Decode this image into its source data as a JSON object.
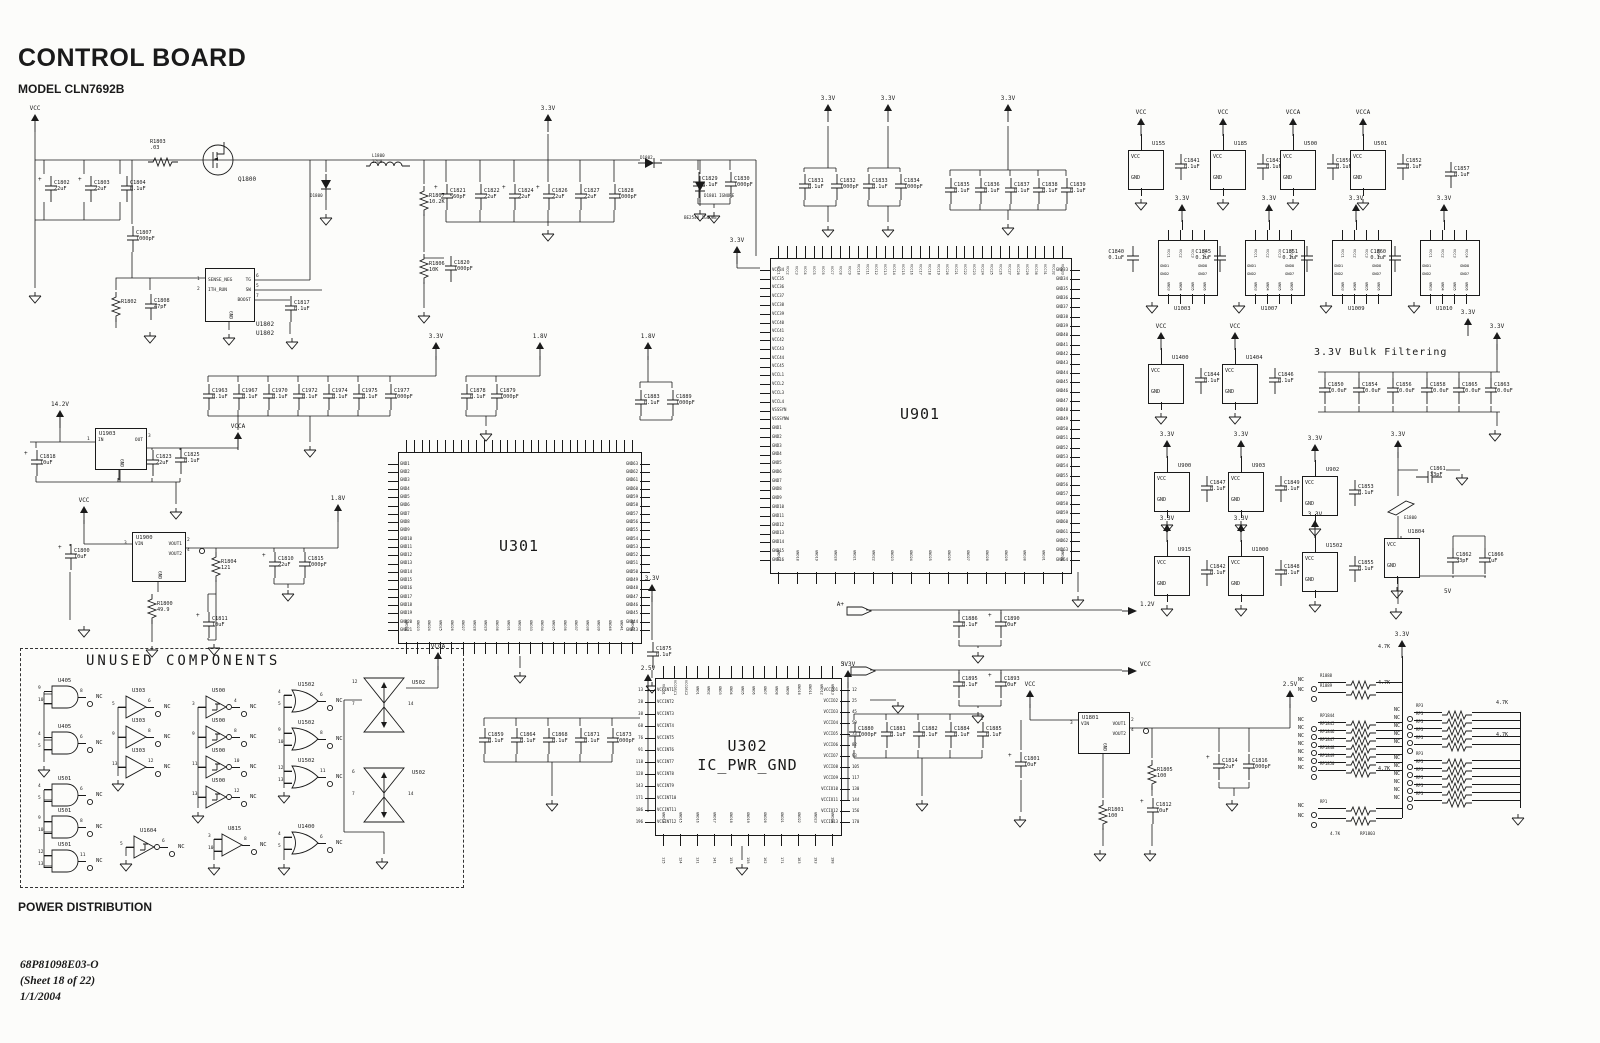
{
  "meta": {
    "title": "CONTROL BOARD",
    "model": "MODEL CLN7692B",
    "section": "POWER DISTRIBUTION",
    "doc": "68P81098E03-O",
    "sheet": "(Sheet 18 of 22)",
    "date": "1/1/2004"
  },
  "labels": [
    [
      "UNUSED COMPONENTS",
      86,
      650,
      "sec"
    ],
    [
      "3.3V Bulk Filtering",
      1314,
      340,
      "bulk"
    ],
    [
      "5V",
      1444,
      578,
      "sm"
    ],
    [
      "BE2540 IGNORE",
      684,
      204,
      "xs"
    ],
    [
      "U1802",
      256,
      320,
      "sm"
    ],
    [
      "Q1800",
      238,
      166,
      "sm"
    ],
    [
      "D1800",
      310,
      182,
      "xs"
    ],
    [
      "D1802",
      640,
      144,
      "xs"
    ],
    [
      "D1801 IGNORE",
      704,
      182,
      "xs"
    ],
    [
      "E1800",
      1404,
      504,
      "xs"
    ],
    [
      "L1800",
      372,
      142,
      "xs"
    ],
    [
      "22uH",
      372,
      148,
      "xs"
    ],
    [
      "RP1803",
      1360,
      820,
      "xs"
    ],
    [
      "4.7K",
      1330,
      820,
      "xs"
    ]
  ],
  "flags": [
    [
      "VCC",
      35,
      114
    ],
    [
      "3.3V",
      548,
      114
    ],
    [
      "3.3V",
      828,
      104
    ],
    [
      "3.3V",
      888,
      104
    ],
    [
      "3.3V",
      1008,
      104
    ],
    [
      "3.3V",
      737,
      246
    ],
    [
      "14.2V",
      60,
      410
    ],
    [
      "3.3V",
      436,
      342
    ],
    [
      "VCCA",
      238,
      432
    ],
    [
      "1.8V",
      540,
      342
    ],
    [
      "1.8V",
      648,
      342
    ],
    [
      "VCC",
      84,
      506
    ],
    [
      "1.8V",
      338,
      504
    ],
    [
      "3.3V",
      652,
      584
    ],
    [
      "2.5V",
      648,
      674
    ],
    [
      "3.3V",
      848,
      670
    ],
    [
      "VCC",
      1030,
      690
    ],
    [
      "2.5V",
      1290,
      690
    ],
    [
      "3.3V",
      1468,
      318
    ],
    [
      "3.3V",
      1497,
      332
    ],
    [
      "3.3V",
      1398,
      440
    ],
    [
      "3.3V",
      1402,
      640
    ],
    [
      "VCCA",
      438,
      652
    ]
  ],
  "tags": [
    [
      "A+",
      846,
      606
    ],
    [
      "5V",
      850,
      666
    ],
    [
      "LOGIC_GND",
      806,
      696
    ]
  ],
  "out_arrows": [
    [
      "1.2V",
      1122,
      606
    ],
    [
      "VCC",
      1122,
      666
    ]
  ],
  "gnds": [
    [
      35,
      290
    ],
    [
      326,
      212
    ],
    [
      229,
      332
    ],
    [
      150,
      330
    ],
    [
      292,
      336
    ],
    [
      424,
      310
    ],
    [
      548,
      228
    ],
    [
      700,
      208
    ],
    [
      714,
      210
    ],
    [
      828,
      224
    ],
    [
      888,
      224
    ],
    [
      1008,
      222
    ],
    [
      310,
      444
    ],
    [
      176,
      506
    ],
    [
      84,
      624
    ],
    [
      152,
      644
    ],
    [
      214,
      642
    ],
    [
      288,
      588
    ],
    [
      486,
      428
    ],
    [
      520,
      670
    ],
    [
      652,
      680
    ],
    [
      742,
      862
    ],
    [
      552,
      798
    ],
    [
      922,
      798
    ],
    [
      978,
      650
    ],
    [
      978,
      710
    ],
    [
      898,
      700
    ],
    [
      1078,
      594
    ],
    [
      1020,
      814
    ],
    [
      1100,
      848
    ],
    [
      1150,
      848
    ],
    [
      1232,
      798
    ],
    [
      1495,
      428
    ],
    [
      1462,
      472
    ],
    [
      1396,
      606
    ],
    [
      1518,
      812
    ],
    [
      44,
      764
    ],
    [
      118,
      778
    ],
    [
      198,
      810
    ],
    [
      284,
      790
    ],
    [
      126,
      858
    ],
    [
      214,
      862
    ],
    [
      284,
      862
    ],
    [
      382,
      856
    ]
  ],
  "caps": [
    [
      "C1802",
      "22uF",
      44,
      176,
      "p"
    ],
    [
      "C1803",
      "22uF",
      84,
      176,
      "p"
    ],
    [
      "C1804",
      "0.1uF",
      120,
      176,
      ""
    ],
    [
      "C1807",
      "1000pF",
      126,
      226,
      ""
    ],
    [
      "C1808",
      "47pF",
      144,
      294,
      ""
    ],
    [
      "C1817",
      "0.1uF",
      284,
      296,
      ""
    ],
    [
      "C1821",
      "560pF",
      440,
      184,
      "p"
    ],
    [
      "C1822",
      "22uF",
      474,
      184,
      ""
    ],
    [
      "C1824",
      "22uF",
      508,
      184,
      "p"
    ],
    [
      "C1826",
      "22uF",
      542,
      184,
      "p"
    ],
    [
      "C1827",
      "22uF",
      574,
      184,
      ""
    ],
    [
      "C1828",
      "1000pF",
      608,
      184,
      ""
    ],
    [
      "C1829",
      "0.1uF",
      692,
      172,
      ""
    ],
    [
      "C1830",
      "1000pF",
      724,
      172,
      ""
    ],
    [
      "C1820",
      "1000pF",
      444,
      256,
      ""
    ],
    [
      "C1818",
      "10uF",
      30,
      450,
      "p"
    ],
    [
      "C1813",
      "0.1uF",
      112,
      454,
      ""
    ],
    [
      "C1823",
      "22uF",
      146,
      450,
      "p"
    ],
    [
      "C1825",
      "0.1uF",
      174,
      448,
      ""
    ],
    [
      "C1800",
      "10uF",
      64,
      544,
      "p"
    ],
    [
      "C1810",
      "22uF",
      268,
      552,
      "p"
    ],
    [
      "C1815",
      "1000pF",
      298,
      552,
      ""
    ],
    [
      "C1811",
      "10uF",
      202,
      612,
      "p"
    ],
    [
      "C1963",
      "0.1uF",
      202,
      384,
      ""
    ],
    [
      "C1967",
      "0.1uF",
      232,
      384,
      ""
    ],
    [
      "C1970",
      "0.1uF",
      262,
      384,
      ""
    ],
    [
      "C1972",
      "0.1uF",
      292,
      384,
      ""
    ],
    [
      "C1974",
      "0.1uF",
      322,
      384,
      ""
    ],
    [
      "C1975",
      "0.1uF",
      352,
      384,
      ""
    ],
    [
      "C1977",
      "1000pF",
      384,
      384,
      ""
    ],
    [
      "C1878",
      "0.1uF",
      460,
      384,
      ""
    ],
    [
      "C1879",
      "1000pF",
      490,
      384,
      ""
    ],
    [
      "C1883",
      "0.1uF",
      634,
      390,
      ""
    ],
    [
      "C1889",
      "1000pF",
      666,
      390,
      ""
    ],
    [
      "C1831",
      "0.1uF",
      798,
      174,
      ""
    ],
    [
      "C1832",
      "1000pF",
      830,
      174,
      ""
    ],
    [
      "C1833",
      "0.1uF",
      862,
      174,
      ""
    ],
    [
      "C1834",
      "1000pF",
      894,
      174,
      ""
    ],
    [
      "C1835",
      "0.1uF",
      944,
      178,
      ""
    ],
    [
      "C1836",
      "0.1uF",
      974,
      178,
      ""
    ],
    [
      "C1837",
      "0.1uF",
      1004,
      178,
      ""
    ],
    [
      "C1838",
      "0.1uF",
      1032,
      178,
      ""
    ],
    [
      "C1839",
      "0.1uF",
      1060,
      178,
      ""
    ],
    [
      "C1875",
      "0.1uF",
      646,
      642,
      ""
    ],
    [
      "C1859",
      "0.1uF",
      478,
      728,
      ""
    ],
    [
      "C1864",
      "0.1uF",
      510,
      728,
      ""
    ],
    [
      "C1868",
      "0.1uF",
      542,
      728,
      ""
    ],
    [
      "C1871",
      "0.1uF",
      574,
      728,
      ""
    ],
    [
      "C1873",
      "1000pF",
      606,
      728,
      ""
    ],
    [
      "C1880",
      "1000pF",
      848,
      722,
      ""
    ],
    [
      "C1881",
      "0.1uF",
      880,
      722,
      ""
    ],
    [
      "C1882",
      "0.1uF",
      912,
      722,
      ""
    ],
    [
      "C1884",
      "0.1uF",
      944,
      722,
      ""
    ],
    [
      "C1885",
      "0.1uF",
      976,
      722,
      ""
    ],
    [
      "C1886",
      "0.1uF",
      952,
      612,
      ""
    ],
    [
      "C1890",
      "10uF",
      994,
      612,
      "p"
    ],
    [
      "C1895",
      "0.1uF",
      952,
      672,
      ""
    ],
    [
      "C1893",
      "10uF",
      994,
      672,
      "p"
    ],
    [
      "C1801",
      "10uF",
      1014,
      752,
      "p"
    ],
    [
      "C1812",
      "10uF",
      1146,
      798,
      "p"
    ],
    [
      "C1814",
      "22uF",
      1212,
      754,
      "p"
    ],
    [
      "C1816",
      "1000pF",
      1242,
      754,
      ""
    ],
    [
      "C1857",
      "0.1uF",
      1444,
      162,
      ""
    ],
    [
      "C1861",
      "33pF",
      1420,
      462,
      "h"
    ],
    [
      "C1862",
      "33pF",
      1446,
      548,
      ""
    ],
    [
      "C1866",
      "1uF",
      1478,
      548,
      ""
    ],
    [
      "C1850",
      "10.0uF",
      1318,
      378,
      ""
    ],
    [
      "C1854",
      "10.0uF",
      1352,
      378,
      ""
    ],
    [
      "C1856",
      "10.0uF",
      1386,
      378,
      ""
    ],
    [
      "C1858",
      "10.0uF",
      1420,
      378,
      ""
    ],
    [
      "C1865",
      "10.0uF",
      1452,
      378,
      ""
    ],
    [
      "C1863",
      "10.0uF",
      1484,
      378,
      ""
    ]
  ],
  "resistors": [
    [
      "R1803",
      ".03",
      148,
      153,
      "h"
    ],
    [
      "R1807",
      "10.2K",
      418,
      186,
      "v"
    ],
    [
      "R1806",
      "10K",
      418,
      254,
      "v"
    ],
    [
      "R1802",
      "",
      110,
      292,
      "v"
    ],
    [
      "R1804",
      "121",
      210,
      552,
      "v"
    ],
    [
      "R1800",
      "49.9",
      146,
      594,
      "v"
    ],
    [
      "R1805",
      "100",
      1146,
      760,
      "v"
    ],
    [
      "R1801",
      "100",
      1097,
      800,
      "v"
    ]
  ],
  "diodes": [
    [
      "D1800",
      320,
      174,
      "v"
    ],
    [
      "D1801",
      694,
      176,
      "v"
    ],
    [
      "D1802",
      638,
      154,
      "h"
    ]
  ],
  "inductor": {
    "ref": "L1800",
    "x": 366,
    "y": 154
  },
  "mosfet": {
    "ref": "Q1800",
    "x": 200,
    "y": 142
  },
  "ferrite": {
    "ref": "E1800",
    "x": 1386,
    "y": 498
  },
  "big_ics": {
    "u901": {
      "ref": "U901",
      "x": 770,
      "y": 258,
      "w": 300,
      "h": 314,
      "left": [
        {
          "p": "VCC",
          "f": 34,
          "t": 45
        },
        {
          "p": "VCCL",
          "f": 1,
          "t": 4
        },
        "VSSSYN",
        "VSSSYNW",
        {
          "p": "GND",
          "f": 1,
          "t": 16
        }
      ],
      "right": [
        {
          "p": "GND",
          "f": 33,
          "t": 64
        }
      ],
      "top": [
        {
          "p": "VCC",
          "f": 1,
          "t": 33
        }
      ],
      "bottom": [
        {
          "p": "GND",
          "f": 17,
          "t": 32
        }
      ]
    },
    "u301": {
      "ref": "U301",
      "x": 398,
      "y": 452,
      "w": 242,
      "h": 190,
      "left": [
        {
          "p": "GND",
          "f": 1,
          "t": 21
        }
      ],
      "right": [
        {
          "p": "GND",
          "f": 63,
          "t": 43
        }
      ],
      "top": {
        "n": 30
      },
      "bottom": [
        {
          "p": "GND",
          "f": 22,
          "t": 42
        }
      ]
    },
    "u302": {
      "ref": "U302",
      "sub": "IC_PWR_GND",
      "x": 655,
      "y": 678,
      "w": 185,
      "h": 156,
      "left": [
        {
          "p": "VCCINT",
          "f": 1,
          "t": 12
        }
      ],
      "leftNums": [
        13,
        28,
        38,
        68,
        76,
        91,
        118,
        128,
        143,
        171,
        186,
        196
      ],
      "right": [
        {
          "p": "VCCIO",
          "f": 1,
          "t": 13
        }
      ],
      "rightNums": [
        12,
        25,
        45,
        59,
        73,
        82,
        93,
        105,
        117,
        130,
        144,
        156,
        170
      ],
      "top": [
        "VCCQ1",
        "VCCOSC1",
        "VCCOSC2",
        {
          "p": "GND",
          "f": 1,
          "t": 13
        }
      ],
      "bottom": [
        {
          "p": "GND",
          "f": 14,
          "t": 24
        }
      ],
      "botNums": [
        115,
        124,
        131,
        141,
        153,
        158,
        162,
        171,
        183,
        193,
        198
      ]
    }
  },
  "small_ics": [
    {
      "ref": "U1802",
      "x": 205,
      "y": 268,
      "w": 48,
      "h": 52,
      "L": [
        [
          "1",
          "SENSE_NEG"
        ],
        [
          "2",
          "ITH_RUN"
        ]
      ],
      "R": [
        [
          "6",
          "TG"
        ],
        [
          "5",
          "SW"
        ],
        [
          "7",
          "BOOST"
        ]
      ],
      "B": [
        "GND"
      ],
      "noref": true
    },
    {
      "ref": "U1903",
      "x": 95,
      "y": 428,
      "w": 50,
      "h": 40,
      "L": [
        [
          "1",
          "IN"
        ]
      ],
      "R": [
        [
          "3",
          "OUT"
        ]
      ],
      "B": [
        "GND"
      ]
    },
    {
      "ref": "U1900",
      "x": 132,
      "y": 532,
      "w": 52,
      "h": 48,
      "L": [
        [
          "3",
          "VIN"
        ]
      ],
      "R": [
        [
          "2",
          "VOUT1"
        ],
        [
          "4",
          "VOUT2"
        ]
      ],
      "B": [
        "GND"
      ],
      "nc": 0
    },
    {
      "ref": "U1801",
      "x": 1078,
      "y": 712,
      "w": 50,
      "h": 40,
      "L": [
        [
          "3",
          "VIN"
        ]
      ],
      "R": [
        [
          "2",
          "VOUT1"
        ],
        [
          "4",
          "VOUT2"
        ]
      ],
      "B": [
        "GND"
      ],
      "nc": 0
    }
  ],
  "pwrblocks": [
    [
      "U155",
      1128,
      150,
      "VCC",
      "C1841",
      "0.1uF"
    ],
    [
      "U185",
      1210,
      150,
      "VCC",
      "C1843",
      "0.1uF"
    ],
    [
      "U500",
      1280,
      150,
      "VCCA",
      "C1850",
      "0.1uF"
    ],
    [
      "U501",
      1350,
      150,
      "VCCA",
      "C1852",
      "0.1uF"
    ],
    [
      "U1400",
      1148,
      364,
      "VCC",
      "C1844",
      "0.1uF"
    ],
    [
      "U1404",
      1222,
      364,
      "VCC",
      "C1846",
      "0.1uF"
    ],
    [
      "U900",
      1154,
      472,
      "3.3V",
      "C1847",
      "0.1uF"
    ],
    [
      "U903",
      1228,
      472,
      "3.3V",
      "C1849",
      "0.1uF"
    ],
    [
      "U902",
      1302,
      476,
      "3.3V",
      "C1853",
      "0.1uF"
    ],
    [
      "U915",
      1154,
      556,
      "3.3V",
      "C1842",
      "0.1uF"
    ],
    [
      "U1000",
      1228,
      556,
      "3.3V",
      "C1848",
      "0.1uF"
    ],
    [
      "U1502",
      1302,
      552,
      "3.3V",
      "C1855",
      "0.1uF"
    ],
    [
      "U1804",
      1384,
      538,
      "",
      "",
      ""
    ]
  ],
  "quads": [
    [
      "U1003",
      1158,
      240,
      "C1840",
      "0.1uF"
    ],
    [
      "U1007",
      1245,
      240,
      "C1845",
      "0.1uF"
    ],
    [
      "U1009",
      1332,
      240,
      "C1851",
      "0.1uF"
    ],
    [
      "U1010",
      1420,
      240,
      "C1860",
      "0.1uF"
    ]
  ],
  "quad_pins": {
    "top": [
      "VCC1",
      "VCC2",
      "VCC3",
      "VCC4"
    ],
    "left": [
      "GND1",
      "GND2"
    ],
    "right": [
      "GND8",
      "GND7"
    ],
    "bottom": [
      "GND3",
      "GND4",
      "GND5",
      "GND6"
    ]
  },
  "unused": {
    "gates": [
      [
        "and",
        "U405",
        52,
        686,
        [
          "9",
          "10"
        ],
        "8"
      ],
      [
        "and",
        "U405",
        52,
        732,
        [
          "4",
          "5"
        ],
        "6"
      ],
      [
        "and",
        "U501",
        52,
        784,
        [
          "4",
          "5"
        ],
        "6"
      ],
      [
        "and",
        "U501",
        52,
        816,
        [
          "9",
          "10"
        ],
        "8"
      ],
      [
        "and",
        "U501",
        52,
        850,
        [
          "12",
          "13"
        ],
        "11"
      ],
      [
        "buf",
        "U303",
        126,
        696,
        [
          "5"
        ],
        "6"
      ],
      [
        "buf",
        "U303",
        126,
        726,
        [
          "9"
        ],
        "8"
      ],
      [
        "buf",
        "U303",
        126,
        756,
        [
          "13"
        ],
        "12"
      ],
      [
        "sinv",
        "U500",
        206,
        696,
        [
          "3"
        ],
        "4"
      ],
      [
        "sinv",
        "U500",
        206,
        726,
        [
          "9"
        ],
        "8"
      ],
      [
        "sinv",
        "U500",
        206,
        756,
        [
          "11"
        ],
        "10"
      ],
      [
        "sinv",
        "U500",
        206,
        786,
        [
          "13"
        ],
        "12"
      ],
      [
        "or",
        "U1502",
        292,
        690,
        [
          "4",
          "5"
        ],
        "6"
      ],
      [
        "or",
        "U1502",
        292,
        728,
        [
          "9",
          "10"
        ],
        "8"
      ],
      [
        "or",
        "U1502",
        292,
        766,
        [
          "12",
          "13"
        ],
        "11"
      ],
      [
        "sinv",
        "U1604",
        134,
        836,
        [
          "5"
        ],
        "6"
      ],
      [
        "buf2",
        "U815",
        222,
        834,
        [
          "3",
          "10"
        ],
        "8"
      ],
      [
        "or",
        "U1400",
        292,
        832,
        [
          "4",
          "5"
        ],
        "6"
      ]
    ],
    "hourglasses": [
      [
        "U502",
        362,
        676,
        "12",
        "7",
        "14"
      ],
      [
        "U502",
        362,
        766,
        "6",
        "7",
        "14"
      ]
    ]
  },
  "networks": [
    {
      "x": 1312,
      "y": 682,
      "dy": 10,
      "refs": [
        "R1888",
        "R1889"
      ],
      "val": "4.7K",
      "rail": 1402,
      "ry1": 656,
      "ry2": 692
    },
    {
      "x": 1312,
      "y": 722,
      "dy": 8,
      "refs": [
        "RP1844",
        "RP1845",
        "RP1846",
        "RP1847",
        "RP1848",
        "RP1849",
        "RP1850"
      ],
      "val": "4.7K",
      "rail": 1402,
      "ry1": 692,
      "ry2": 778
    },
    {
      "x": 1312,
      "y": 808,
      "dy": 10,
      "refs": [
        "RP1",
        ""
      ],
      "val": "4.7K",
      "rail": 1402,
      "ry1": 778,
      "ry2": 818
    },
    {
      "x": 1408,
      "y": 712,
      "dy": 8,
      "refs": [
        "RP3",
        "RP3",
        "RP3",
        "RP3",
        "RP3"
      ],
      "val": "4.7K",
      "rail": 1520,
      "ry1": 712,
      "ry2": 744
    },
    {
      "x": 1408,
      "y": 760,
      "dy": 8,
      "refs": [
        "RP3",
        "RP3",
        "RP3",
        "RP3",
        "RP3",
        "RP3"
      ],
      "val": "4.7K",
      "rail": 1520,
      "ry1": 744,
      "ry2": 808
    }
  ]
}
